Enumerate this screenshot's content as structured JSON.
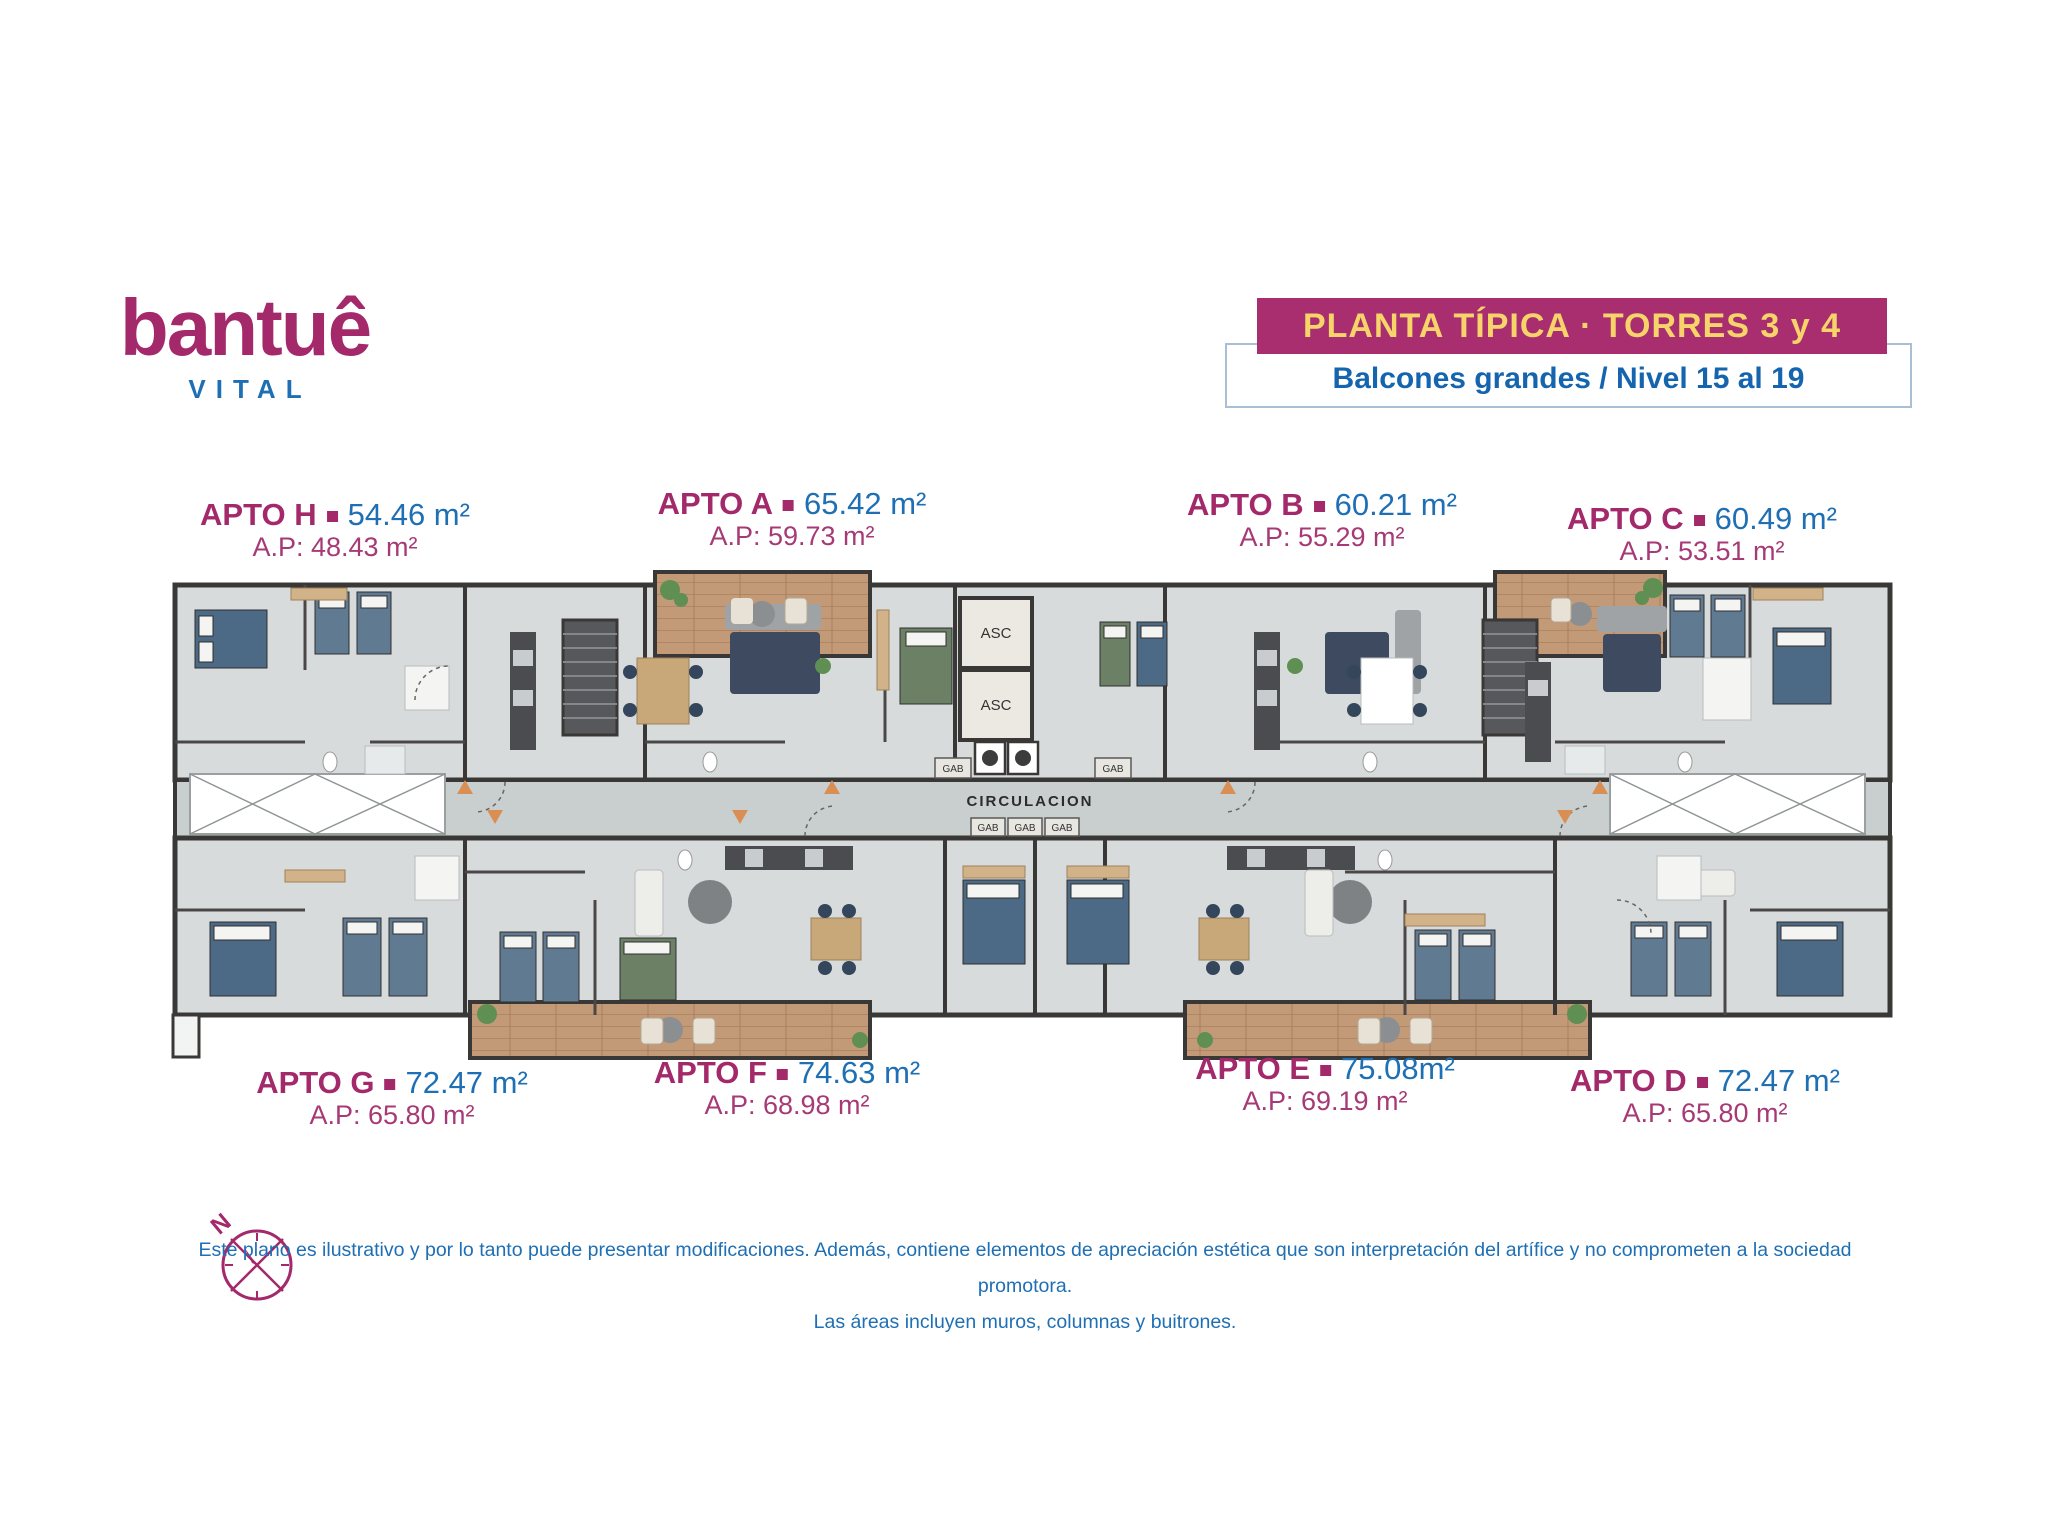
{
  "logo": {
    "name": "bantuê",
    "tagline": "VITAL"
  },
  "header": {
    "banner": "PLANTA TÍPICA · TORRES 3 y 4",
    "subtitle": "Balcones grandes / Nivel 15 al 19"
  },
  "apartments": [
    {
      "id": "H",
      "name": "APTO H",
      "area": "54.46 m²",
      "private_area": "A.P: 48.43 m²"
    },
    {
      "id": "A",
      "name": "APTO A",
      "area": "65.42 m²",
      "private_area": "A.P: 59.73 m²"
    },
    {
      "id": "B",
      "name": "APTO B",
      "area": "60.21 m²",
      "private_area": "A.P: 55.29 m²"
    },
    {
      "id": "C",
      "name": "APTO C",
      "area": "60.49 m²",
      "private_area": "A.P: 53.51 m²"
    },
    {
      "id": "G",
      "name": "APTO G",
      "area": "72.47 m²",
      "private_area": "A.P: 65.80 m²"
    },
    {
      "id": "F",
      "name": "APTO F",
      "area": "74.63 m²",
      "private_area": "A.P: 68.98 m²"
    },
    {
      "id": "E",
      "name": "APTO E",
      "area": "75.08m²",
      "private_area": "A.P: 69.19 m²"
    },
    {
      "id": "D",
      "name": "APTO D",
      "area": "72.47 m²",
      "private_area": "A.P: 65.80 m²"
    }
  ],
  "plan_labels": {
    "elevator": "ASC",
    "closet": "GAB",
    "corridor": "CIRCULACION",
    "north": "N"
  },
  "disclaimer": {
    "line1": "Este plano es ilustrativo y por lo tanto puede presentar modificaciones. Además, contiene elementos de apreciación estética que son interpretación del artífice y no comprometen a la sociedad promotora.",
    "line2": "Las áreas incluyen muros, columnas y buitrones."
  },
  "icons": {
    "separator": "square-bullet",
    "compass": "compass-rose-north"
  },
  "colors": {
    "magenta": "#A3296B",
    "blue": "#1E6FB4",
    "banner_bg": "#A82E70",
    "banner_text": "#F6D46A",
    "box_border": "#A9BFD6",
    "floor": "#D8DBDC",
    "corridor": "#C9CFCE",
    "wall": "#3A3836",
    "wood": "#C39A77"
  }
}
